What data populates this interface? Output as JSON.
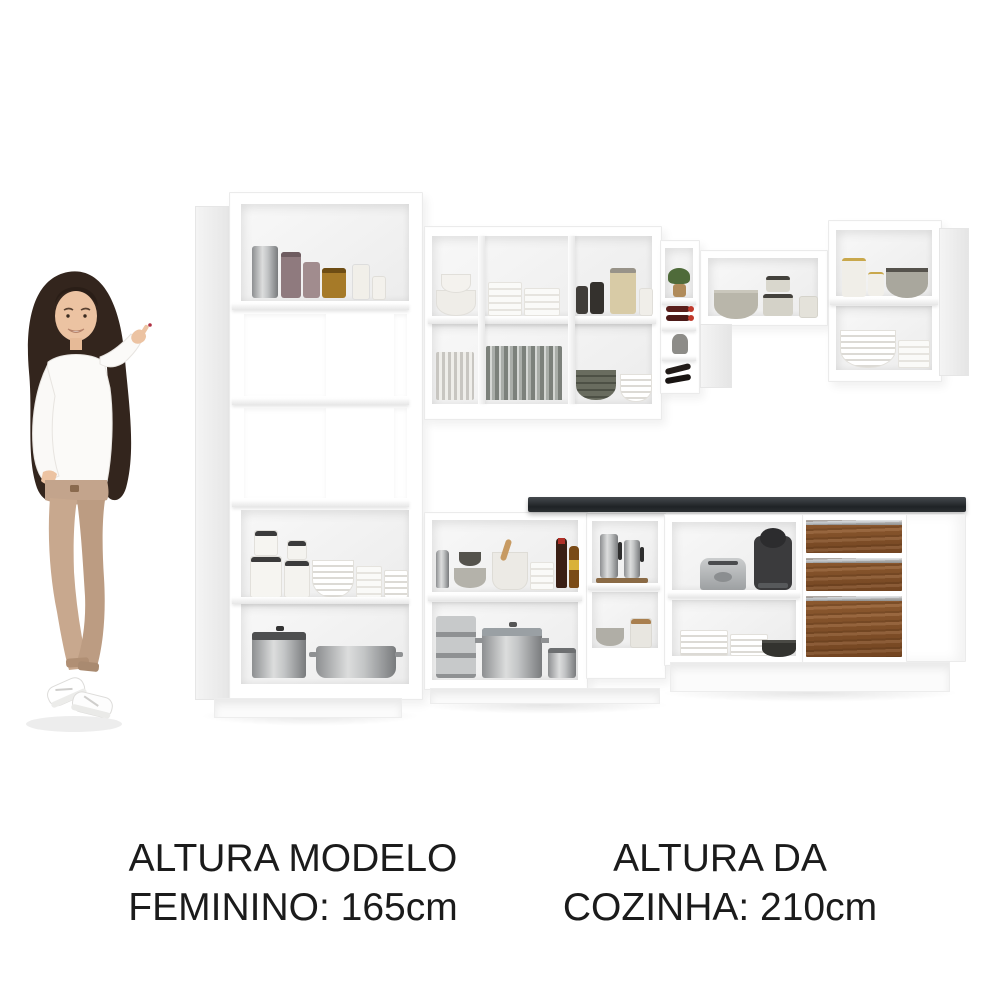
{
  "page": {
    "kind": "product image",
    "background": "#ffffff"
  },
  "captions": {
    "model_height": {
      "line1": "ALTURA MODELO",
      "line2": "FEMININO: 165cm"
    },
    "kitchen_height": {
      "line1": "ALTURA DA",
      "line2": "COZINHA: 210cm"
    }
  },
  "colors": {
    "cabinet_white": "#ffffff",
    "interior_shadow": "#ececec",
    "countertop_black": "#24282b",
    "drawer_wood_brown": "#8a5730",
    "handle_aluminum": "#b9bdc0",
    "caption_text": "#1b1b1b",
    "wine_cap_red": "#c0392b",
    "model_pants_beige": "#c3a48c",
    "model_hair_brown": "#33251d"
  },
  "scene": {
    "model": {
      "pose": "smiling woman pointing up toward the kitchen",
      "top": "white knit sweater",
      "pants": "beige high-waist trousers",
      "shoes": "white sneakers"
    },
    "kitchen": {
      "layout": "L-shaped corner kitchen with open shelves (no doors)",
      "finish": {
        "cabinets": "white",
        "countertop": "black",
        "drawer_fronts": "rustic brown wood"
      },
      "sections": [
        {
          "name": "tall-tower-cabinet",
          "items": [
            "steel canister",
            "taupe canisters",
            "amber jar",
            "white jars",
            "lidded canisters",
            "bowl stack",
            "cup stack",
            "plate stack",
            "lidded pot",
            "casserole pan"
          ]
        },
        {
          "name": "upper-wall-cabinet-left",
          "items": [
            "white bowl stack",
            "cup and saucer stacks",
            "dark jars",
            "beige mason jar",
            "side plates",
            "drinking glasses",
            "olive bowl stack",
            "white bowl stack"
          ]
        },
        {
          "name": "corner-wine-rack",
          "items": [
            "plant",
            "wine bottles",
            "gray vase",
            "dark bottles"
          ]
        },
        {
          "name": "upper-wall-cabinet-right",
          "items": [
            "scalloped gray bowl",
            "canister stacks",
            "gold-rim canisters",
            "gray bowl",
            "large bowl stack",
            "small bowl stack"
          ]
        },
        {
          "name": "base-cabinet-middle",
          "items": [
            "grater",
            "gray bowls",
            "mortar and pestle",
            "small bowls",
            "oil bottles",
            "steamer pot stack",
            "pot with glass lid",
            "small pot"
          ]
        },
        {
          "name": "corner-base-cabinet",
          "items": [
            "steel pitchers on tray",
            "gray bowl",
            "wood-lid canister"
          ]
        },
        {
          "name": "base-cabinet-right",
          "items": [
            "toaster",
            "capsule coffee machine",
            "plate stacks",
            "dark frying pan"
          ]
        },
        {
          "name": "drawer-unit",
          "drawers": 3
        }
      ]
    }
  }
}
